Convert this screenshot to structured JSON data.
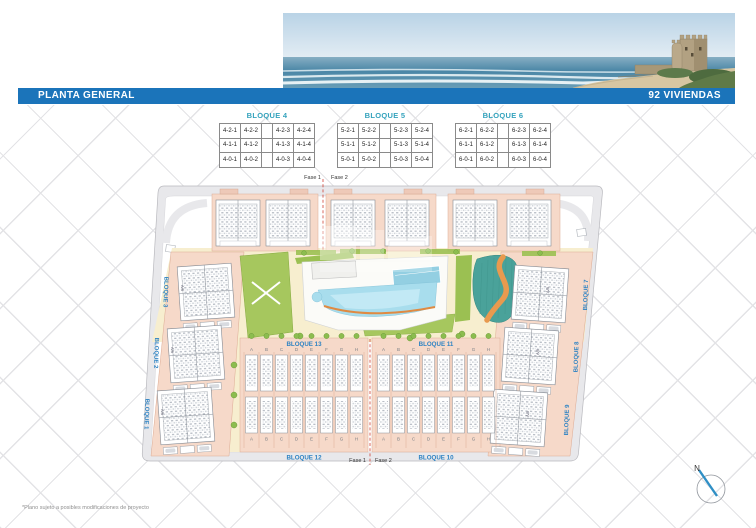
{
  "title_bar": {
    "left": "PLANTA GENERAL",
    "right": "92 VIVIENDAS"
  },
  "unit_tables": [
    {
      "title": "BLOQUE 4",
      "rows": [
        [
          "4-2-1",
          "4-2-2",
          "",
          "4-2-3",
          "4-2-4"
        ],
        [
          "4-1-1",
          "4-1-2",
          "",
          "4-1-3",
          "4-1-4"
        ],
        [
          "4-0-1",
          "4-0-2",
          "",
          "4-0-3",
          "4-0-4"
        ]
      ]
    },
    {
      "title": "BLOQUE 5",
      "rows": [
        [
          "5-2-1",
          "5-2-2",
          "",
          "5-2-3",
          "5-2-4"
        ],
        [
          "5-1-1",
          "5-1-2",
          "",
          "5-1-3",
          "5-1-4"
        ],
        [
          "5-0-1",
          "5-0-2",
          "",
          "5-0-3",
          "5-0-4"
        ]
      ]
    },
    {
      "title": "BLOQUE 6",
      "rows": [
        [
          "6-2-1",
          "6-2-2",
          "",
          "6-2-3",
          "6-2-4"
        ],
        [
          "6-1-1",
          "6-1-2",
          "",
          "6-1-3",
          "6-1-4"
        ],
        [
          "6-0-1",
          "6-0-2",
          "",
          "6-0-3",
          "6-0-4"
        ]
      ]
    }
  ],
  "plan": {
    "phase_labels": {
      "top": [
        "Fase 1",
        "Fase 2"
      ],
      "bottom": [
        "Fase 1",
        "Fase 2"
      ]
    },
    "road_labels_left": [
      "BLOQUE 3",
      "BLOQUE 2",
      "BLOQUE 1"
    ],
    "road_labels_right": [
      "BLOQUE 7",
      "BLOQUE 8",
      "BLOQUE 9"
    ],
    "townhouse_groups": [
      {
        "label_top": "BLOQUE 13",
        "label_bottom": "BLOQUE 12",
        "unit_letters": [
          "A",
          "B",
          "C",
          "D",
          "E",
          "F",
          "G",
          "H"
        ]
      },
      {
        "label_top": "BLOQUE 11",
        "label_bottom": "BLOQUE 10",
        "unit_letters": [
          "A",
          "B",
          "C",
          "D",
          "E",
          "F",
          "G",
          "H"
        ]
      }
    ],
    "cluster_unit_label": "A/B",
    "compass": {
      "north_label": "N"
    }
  },
  "footnote": "*Plano sujeto a posibles modificaciones de proyecto",
  "colors": {
    "accent_blue": "#1b74ba",
    "table_header_teal": "#35a3bd",
    "plan_label_blue": "#2e83c3",
    "phase_divider_red": "#cf4338"
  }
}
